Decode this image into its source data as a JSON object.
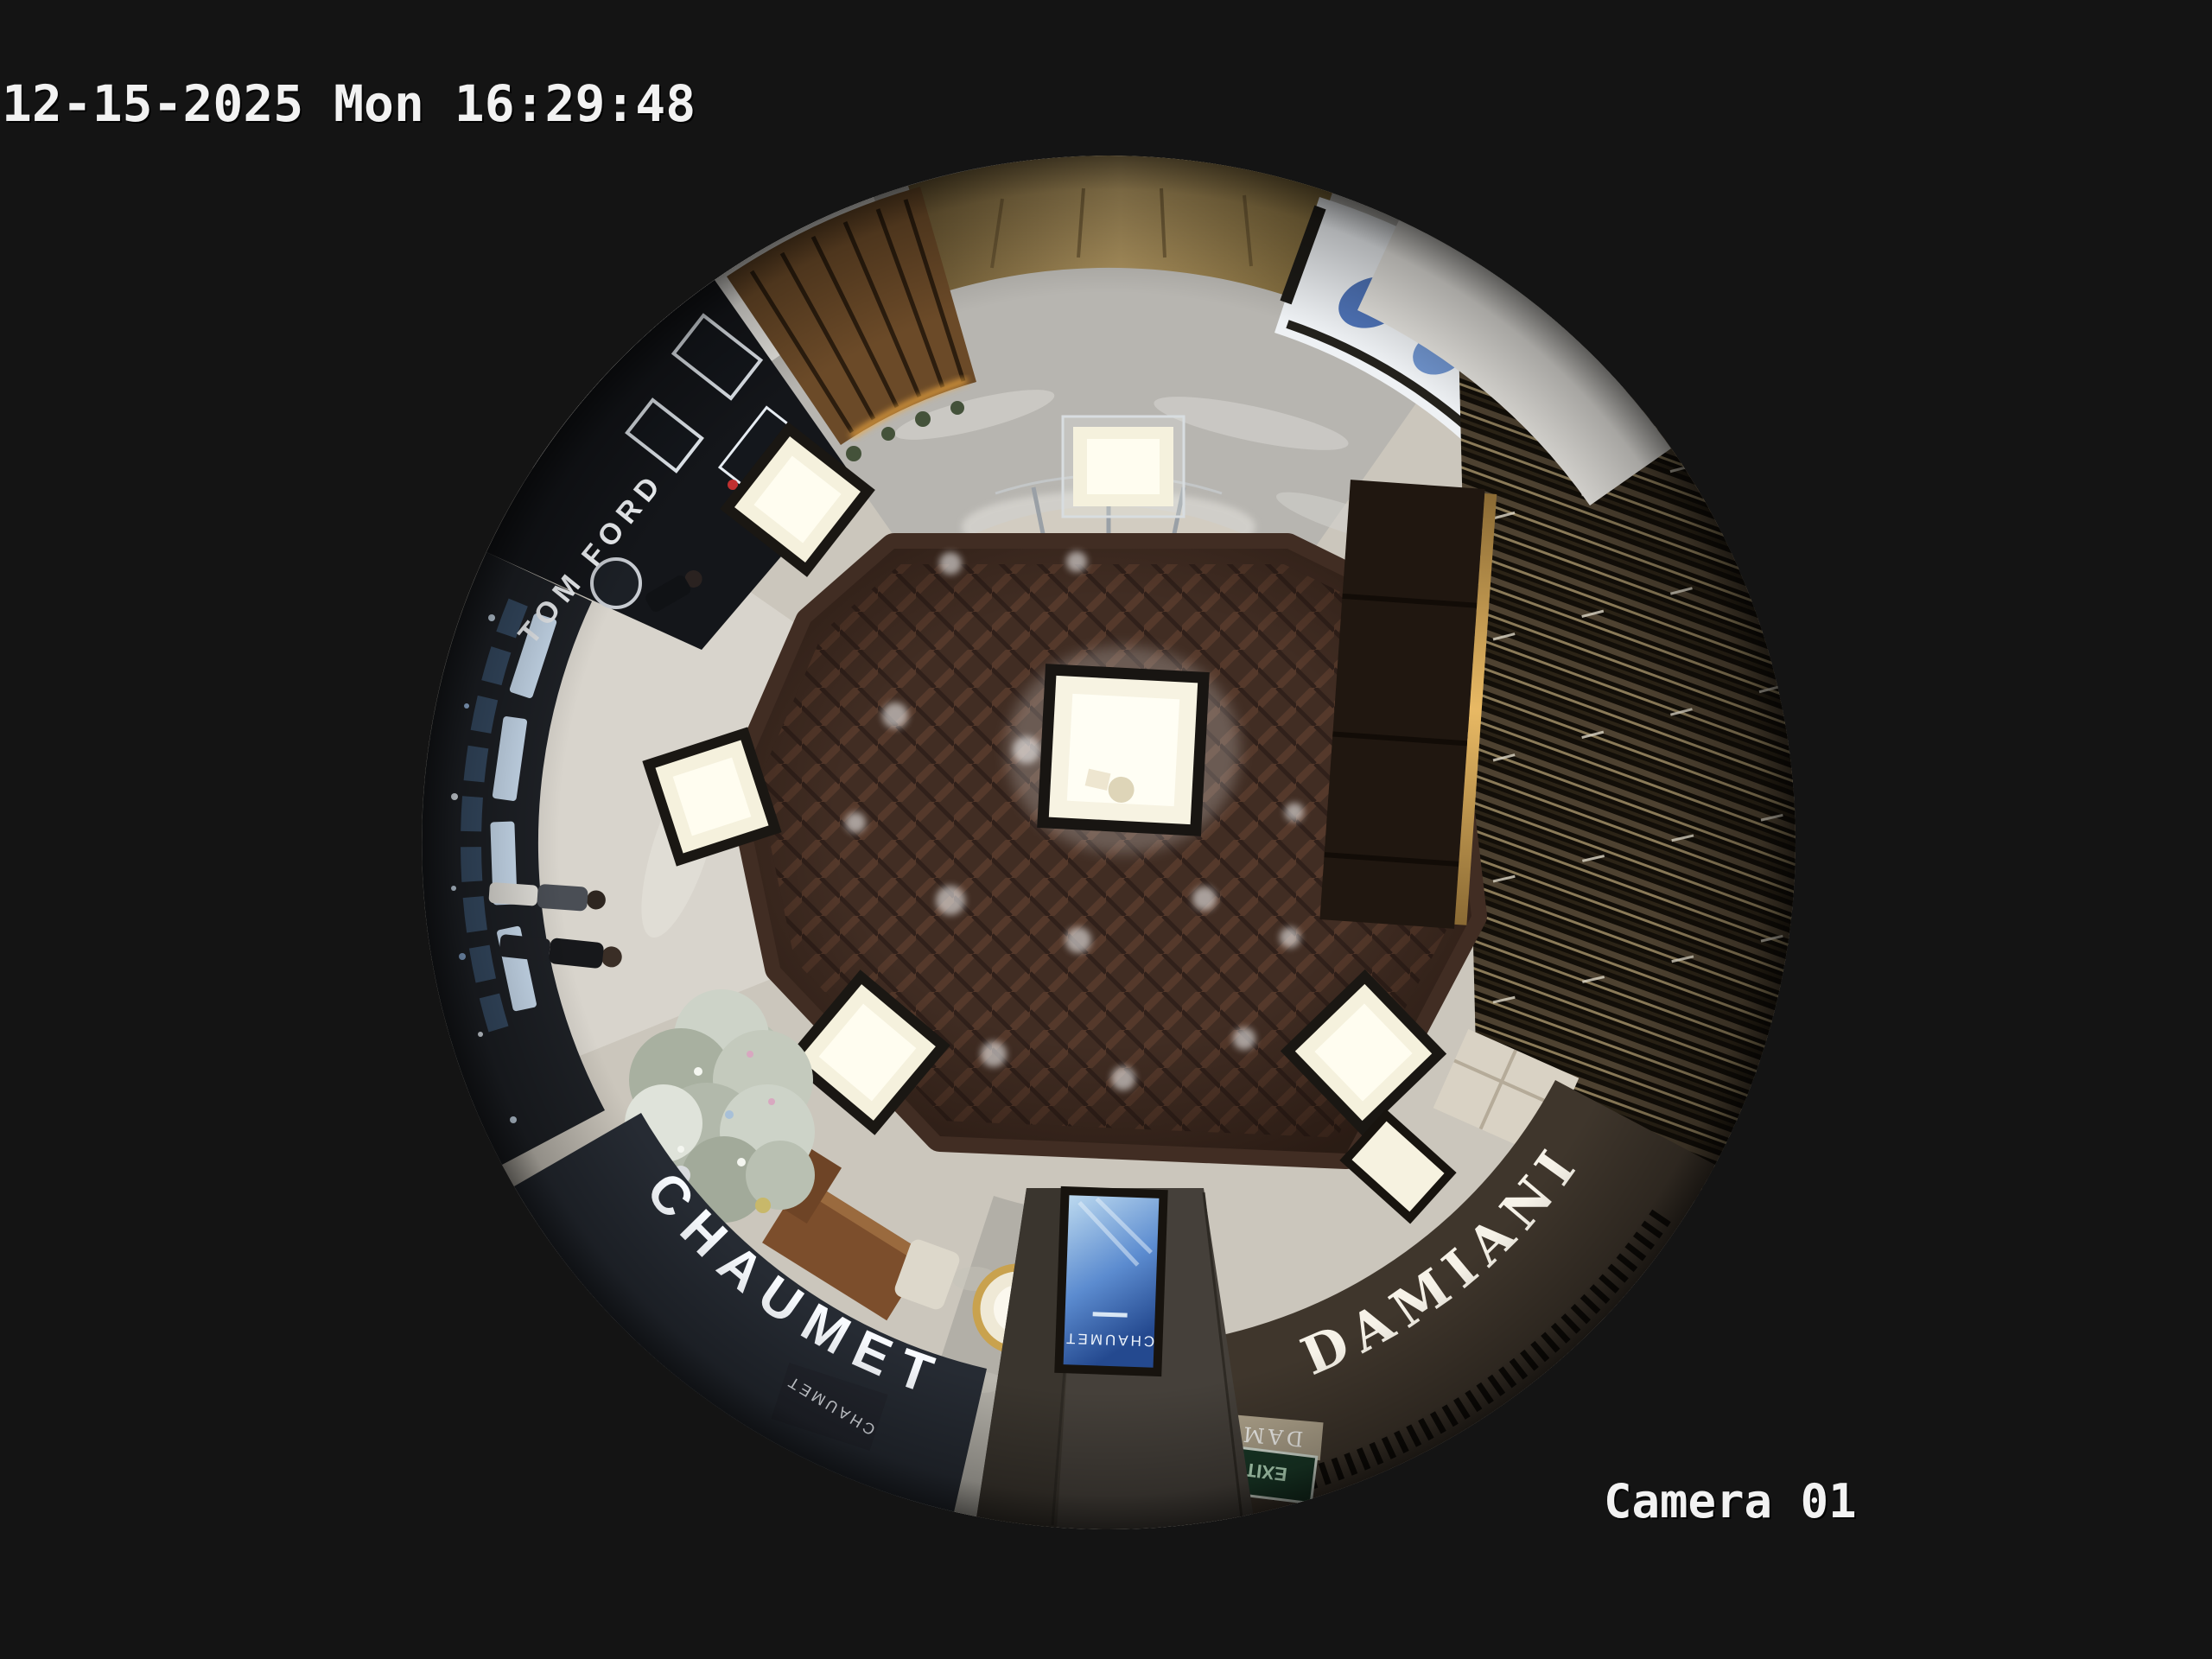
{
  "osd": {
    "timestamp": "12-15-2025 Mon 16:29:48",
    "camera_label": "Camera 01"
  },
  "video": {
    "signs": {
      "tom_ford": "TOM FORD",
      "chaumet": "CHAUMET",
      "chaumet_pylon": "CHAUMET",
      "damiani": "DAMIANI",
      "damiani_entrance": "DAMIANI",
      "ad_screen_brand": "CHAUMET",
      "exit_sign": "EXIT"
    },
    "colors": {
      "frame_background": "#131313",
      "osd_text": "#f2f2f2",
      "wood_floor": "#412d23",
      "marble_floor": "#b8b6b1",
      "tile_floor": "#cbc6bc",
      "chaumet_fascia": "#262b33",
      "damiani_fascia": "#3f362c",
      "ad_screen_blue": "#2d5aa8",
      "exit_sign_green": "#1a3a28",
      "led_amber": "#e8b964",
      "case_glow": "#fffdf0"
    }
  }
}
